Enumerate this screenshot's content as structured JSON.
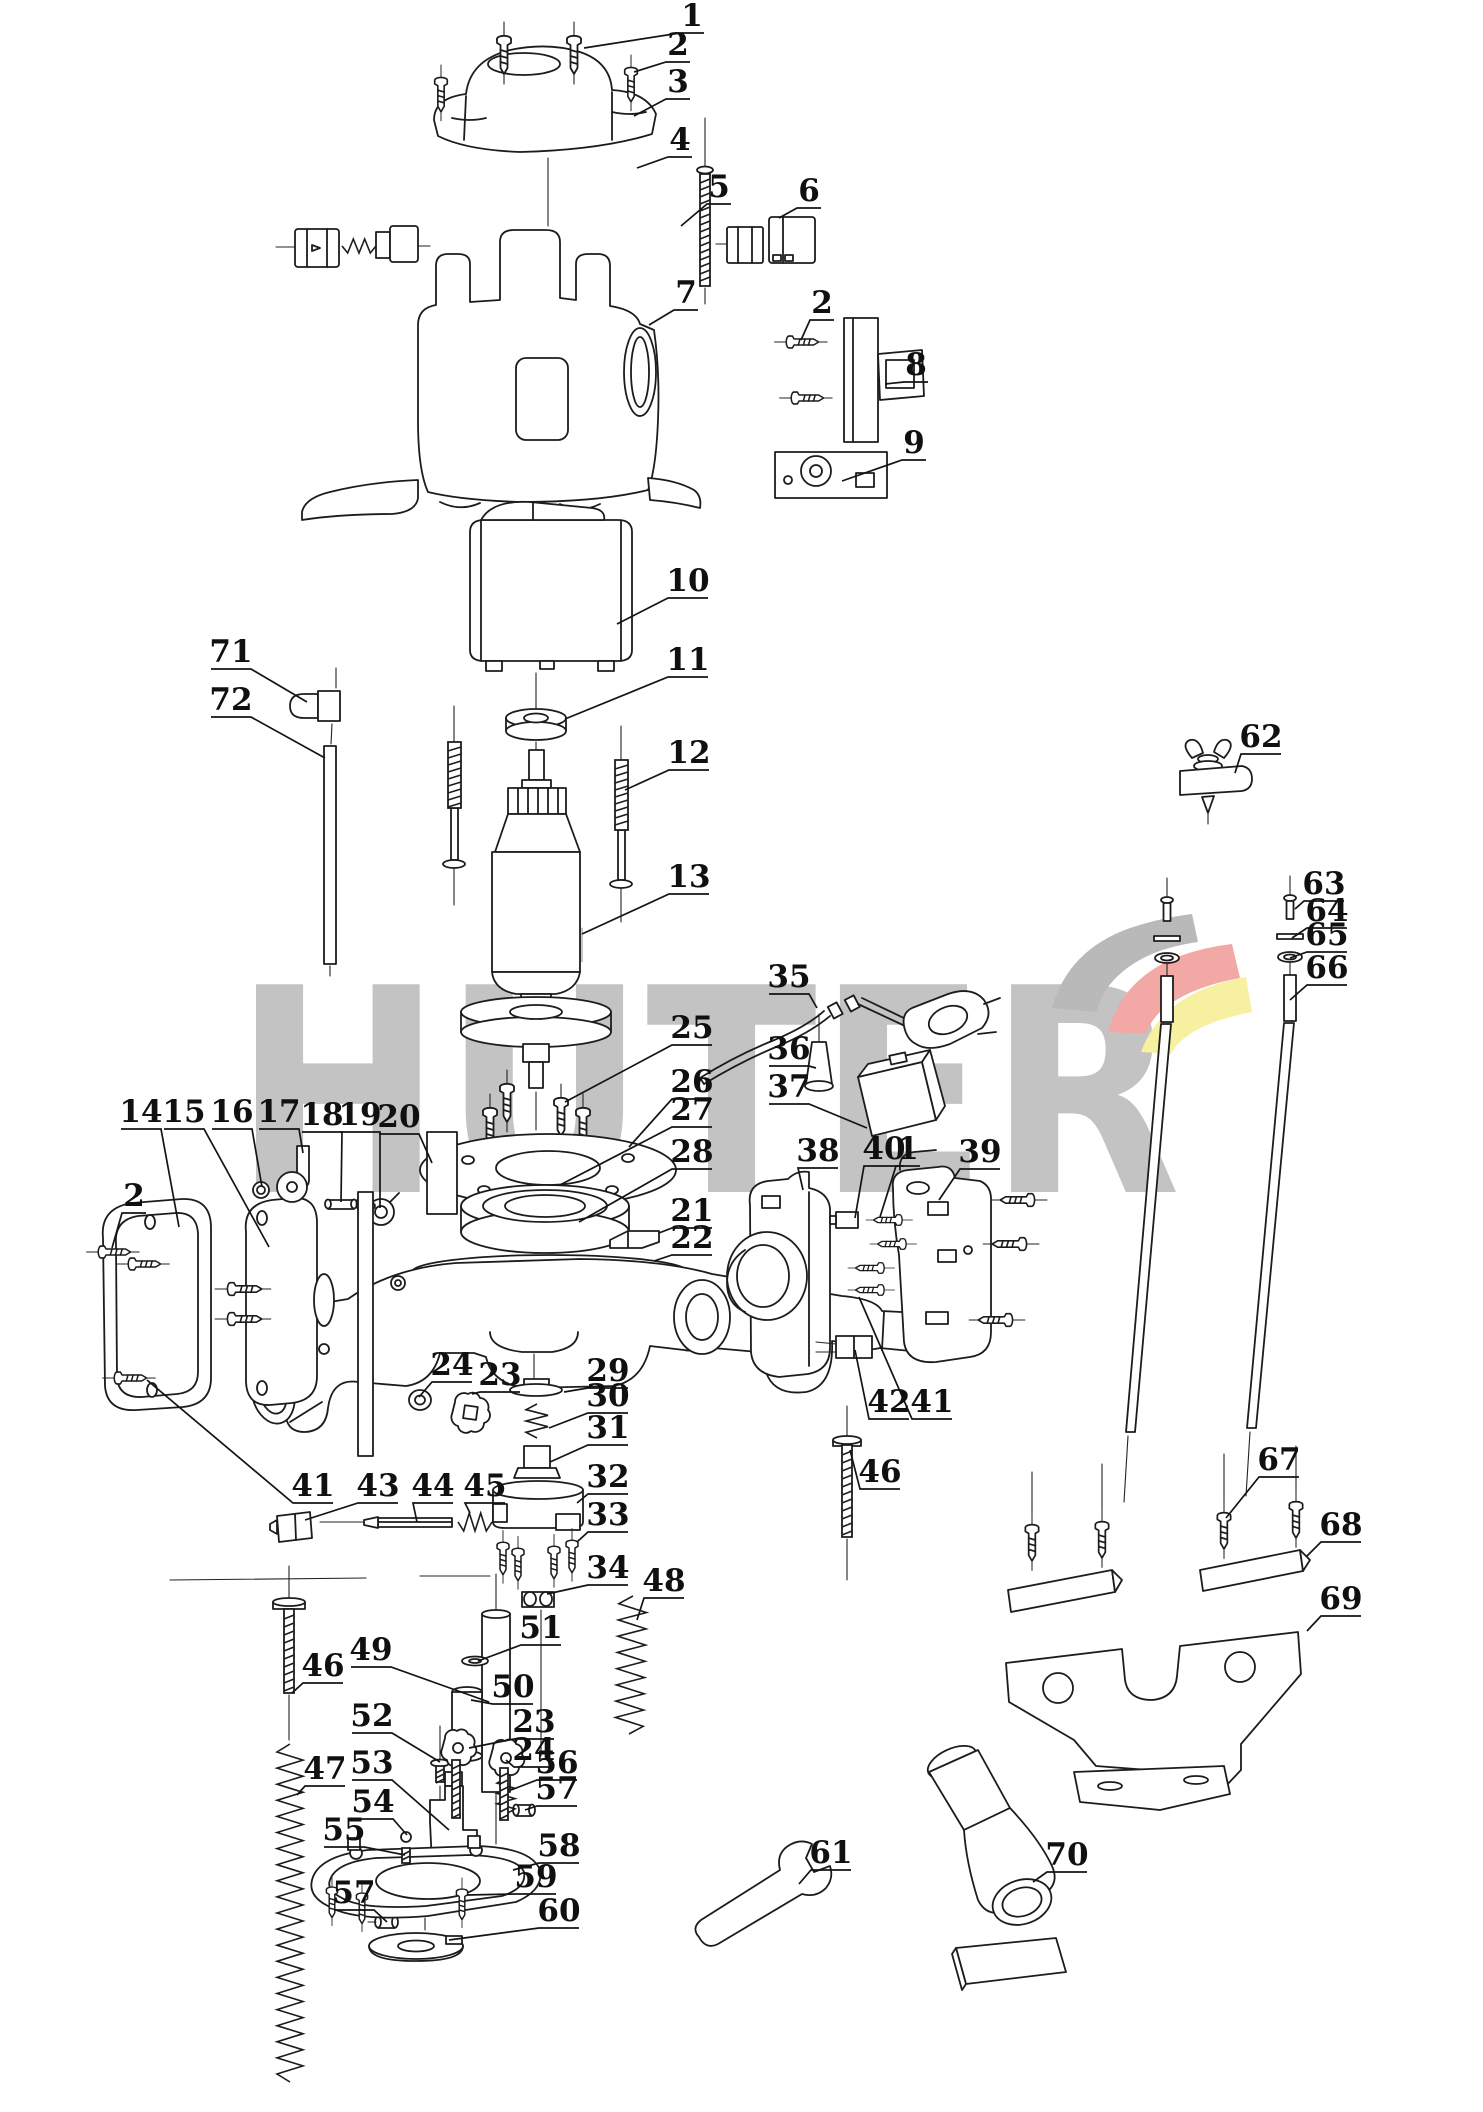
{
  "watermark": {
    "text": "HÜTER",
    "text_color": "#c3c3c3",
    "logo_colors": {
      "gray": "#b9b9b9",
      "red": "#f2a9a6",
      "yellow": "#f7f0a0"
    }
  },
  "canvas": {
    "width": 1483,
    "height": 2112,
    "background": "#ffffff",
    "line_color": "#1c1c1c"
  },
  "callouts": [
    {
      "id": "1",
      "n": "1",
      "x": 692,
      "y": 16,
      "tx": 584,
      "ty": 48
    },
    {
      "id": "2a",
      "n": "2",
      "x": 678,
      "y": 45,
      "tx": 634,
      "ty": 72
    },
    {
      "id": "3",
      "n": "3",
      "x": 678,
      "y": 82,
      "tx": 634,
      "ty": 116
    },
    {
      "id": "4",
      "n": "4",
      "x": 680,
      "y": 140,
      "tx": 637,
      "ty": 168
    },
    {
      "id": "5",
      "n": "5",
      "x": 719,
      "y": 187,
      "tx": 681,
      "ty": 226
    },
    {
      "id": "6",
      "n": "6",
      "x": 809,
      "y": 191,
      "tx": 779,
      "ty": 218
    },
    {
      "id": "7",
      "n": "7",
      "x": 686,
      "y": 293,
      "tx": 649,
      "ty": 325
    },
    {
      "id": "2b",
      "n": "2",
      "x": 822,
      "y": 303,
      "tx": 801,
      "ty": 340
    },
    {
      "id": "8",
      "n": "8",
      "x": 916,
      "y": 365,
      "tx": 885,
      "ty": 384
    },
    {
      "id": "9",
      "n": "9",
      "x": 914,
      "y": 443,
      "tx": 842,
      "ty": 481
    },
    {
      "id": "10",
      "n": "10",
      "x": 688,
      "y": 581,
      "tx": 617,
      "ty": 624
    },
    {
      "id": "11",
      "n": "11",
      "x": 688,
      "y": 660,
      "tx": 565,
      "ty": 719
    },
    {
      "id": "12",
      "n": "12",
      "x": 689,
      "y": 753,
      "tx": 625,
      "ty": 790
    },
    {
      "id": "13",
      "n": "13",
      "x": 689,
      "y": 877,
      "tx": 582,
      "ty": 934
    },
    {
      "id": "71",
      "n": "71",
      "x": 231,
      "y": 652,
      "tx": 307,
      "ty": 702
    },
    {
      "id": "72",
      "n": "72",
      "x": 231,
      "y": 700,
      "tx": 325,
      "ty": 758
    },
    {
      "id": "62",
      "n": "62",
      "x": 1261,
      "y": 737,
      "tx": 1235,
      "ty": 773
    },
    {
      "id": "63",
      "n": "63",
      "x": 1324,
      "y": 884,
      "tx": 1295,
      "ty": 909
    },
    {
      "id": "64",
      "n": "64",
      "x": 1327,
      "y": 911,
      "tx": 1292,
      "ty": 938
    },
    {
      "id": "65",
      "n": "65",
      "x": 1327,
      "y": 935,
      "tx": 1290,
      "ty": 958
    },
    {
      "id": "66",
      "n": "66",
      "x": 1327,
      "y": 968,
      "tx": 1290,
      "ty": 1000
    },
    {
      "id": "25",
      "n": "25",
      "x": 692,
      "y": 1028,
      "tx": 565,
      "ty": 1102
    },
    {
      "id": "26",
      "n": "26",
      "x": 692,
      "y": 1082,
      "tx": 629,
      "ty": 1147
    },
    {
      "id": "27",
      "n": "27",
      "x": 692,
      "y": 1110,
      "tx": 560,
      "ty": 1185
    },
    {
      "id": "28",
      "n": "28",
      "x": 692,
      "y": 1152,
      "tx": 579,
      "ty": 1222
    },
    {
      "id": "21",
      "n": "21",
      "x": 692,
      "y": 1211,
      "tx": 659,
      "ty": 1233
    },
    {
      "id": "22",
      "n": "22",
      "x": 692,
      "y": 1238,
      "tx": 654,
      "ty": 1261
    },
    {
      "id": "35",
      "n": "35",
      "x": 789,
      "y": 977,
      "tx": 817,
      "ty": 1008
    },
    {
      "id": "36",
      "n": "36",
      "x": 789,
      "y": 1049,
      "tx": 816,
      "ty": 1068
    },
    {
      "id": "37",
      "n": "37",
      "x": 789,
      "y": 1087,
      "tx": 867,
      "ty": 1128
    },
    {
      "id": "38",
      "n": "38",
      "x": 818,
      "y": 1151,
      "tx": 803,
      "ty": 1190
    },
    {
      "id": "40",
      "n": "40",
      "x": 884,
      "y": 1149,
      "tx": 855,
      "ty": 1218
    },
    {
      "id": "1b",
      "n": "1",
      "x": 908,
      "y": 1149,
      "tx": 880,
      "ty": 1217
    },
    {
      "id": "39",
      "n": "39",
      "x": 980,
      "y": 1152,
      "tx": 939,
      "ty": 1200
    },
    {
      "id": "41b",
      "n": "41",
      "x": 932,
      "y": 1402,
      "tx": 859,
      "ty": 1297
    },
    {
      "id": "42",
      "n": "42",
      "x": 889,
      "y": 1402,
      "tx": 855,
      "ty": 1350
    },
    {
      "id": "46b",
      "n": "46",
      "x": 880,
      "y": 1472,
      "tx": 850,
      "ty": 1450
    },
    {
      "id": "14",
      "n": "14",
      "x": 141,
      "y": 1112,
      "tx": 179,
      "ty": 1227
    },
    {
      "id": "15",
      "n": "15",
      "x": 184,
      "y": 1112,
      "tx": 269,
      "ty": 1247
    },
    {
      "id": "16",
      "n": "16",
      "x": 232,
      "y": 1112,
      "tx": 262,
      "ty": 1187
    },
    {
      "id": "17",
      "n": "17",
      "x": 279,
      "y": 1112,
      "tx": 303,
      "ty": 1153
    },
    {
      "id": "18",
      "n": "18",
      "x": 322,
      "y": 1115,
      "tx": 341,
      "ty": 1202
    },
    {
      "id": "19",
      "n": "19",
      "x": 360,
      "y": 1115,
      "tx": 380,
      "ty": 1208
    },
    {
      "id": "20",
      "n": "20",
      "x": 399,
      "y": 1117,
      "tx": 432,
      "ty": 1163
    },
    {
      "id": "2c",
      "n": "2",
      "x": 134,
      "y": 1196,
      "tx": 112,
      "ty": 1248
    },
    {
      "id": "24a",
      "n": "24",
      "x": 452,
      "y": 1365,
      "tx": 419,
      "ty": 1397
    },
    {
      "id": "23a",
      "n": "23",
      "x": 500,
      "y": 1375,
      "tx": 472,
      "ty": 1394
    },
    {
      "id": "29",
      "n": "29",
      "x": 608,
      "y": 1371,
      "tx": 564,
      "ty": 1392
    },
    {
      "id": "30",
      "n": "30",
      "x": 608,
      "y": 1396,
      "tx": 549,
      "ty": 1428
    },
    {
      "id": "31",
      "n": "31",
      "x": 608,
      "y": 1428,
      "tx": 550,
      "ty": 1462
    },
    {
      "id": "32",
      "n": "32",
      "x": 608,
      "y": 1477,
      "tx": 577,
      "ty": 1503
    },
    {
      "id": "33",
      "n": "33",
      "x": 608,
      "y": 1515,
      "tx": 577,
      "ty": 1542
    },
    {
      "id": "34",
      "n": "34",
      "x": 608,
      "y": 1568,
      "tx": 547,
      "ty": 1594
    },
    {
      "id": "41a",
      "n": "41",
      "x": 313,
      "y": 1486,
      "tx": 147,
      "ty": 1380
    },
    {
      "id": "43",
      "n": "43",
      "x": 378,
      "y": 1486,
      "tx": 305,
      "ty": 1520
    },
    {
      "id": "44",
      "n": "44",
      "x": 433,
      "y": 1486,
      "tx": 417,
      "ty": 1522
    },
    {
      "id": "45",
      "n": "45",
      "x": 485,
      "y": 1486,
      "tx": 470,
      "ty": 1513
    },
    {
      "id": "46a",
      "n": "46",
      "x": 323,
      "y": 1666,
      "tx": 292,
      "ty": 1693
    },
    {
      "id": "47",
      "n": "47",
      "x": 325,
      "y": 1769,
      "tx": 297,
      "ty": 1795
    },
    {
      "id": "49",
      "n": "49",
      "x": 371,
      "y": 1650,
      "tx": 489,
      "ty": 1702
    },
    {
      "id": "52",
      "n": "52",
      "x": 372,
      "y": 1716,
      "tx": 440,
      "ty": 1762
    },
    {
      "id": "53",
      "n": "53",
      "x": 372,
      "y": 1763,
      "tx": 449,
      "ty": 1830
    },
    {
      "id": "54",
      "n": "54",
      "x": 373,
      "y": 1802,
      "tx": 407,
      "ty": 1835
    },
    {
      "id": "55",
      "n": "55",
      "x": 344,
      "y": 1830,
      "tx": 405,
      "ty": 1855
    },
    {
      "id": "57a",
      "n": "57",
      "x": 354,
      "y": 1893,
      "tx": 387,
      "ty": 1922
    },
    {
      "id": "51",
      "n": "51",
      "x": 541,
      "y": 1628,
      "tx": 478,
      "ty": 1661
    },
    {
      "id": "50",
      "n": "50",
      "x": 513,
      "y": 1687,
      "tx": 471,
      "ty": 1700
    },
    {
      "id": "23b",
      "n": "23",
      "x": 534,
      "y": 1722,
      "tx": 469,
      "ty": 1748
    },
    {
      "id": "24b",
      "n": "24",
      "x": 534,
      "y": 1750,
      "tx": 506,
      "ty": 1760
    },
    {
      "id": "56",
      "n": "56",
      "x": 557,
      "y": 1763,
      "tx": 511,
      "ty": 1790
    },
    {
      "id": "57b",
      "n": "57",
      "x": 557,
      "y": 1789,
      "tx": 525,
      "ty": 1810
    },
    {
      "id": "58",
      "n": "58",
      "x": 559,
      "y": 1846,
      "tx": 513,
      "ty": 1870
    },
    {
      "id": "59",
      "n": "59",
      "x": 536,
      "y": 1877,
      "tx": 467,
      "ty": 1895
    },
    {
      "id": "60",
      "n": "60",
      "x": 559,
      "y": 1911,
      "tx": 449,
      "ty": 1940
    },
    {
      "id": "48",
      "n": "48",
      "x": 664,
      "y": 1581,
      "tx": 637,
      "ty": 1620
    },
    {
      "id": "61",
      "n": "61",
      "x": 831,
      "y": 1853,
      "tx": 799,
      "ty": 1884
    },
    {
      "id": "70",
      "n": "70",
      "x": 1067,
      "y": 1855,
      "tx": 1033,
      "ty": 1882
    },
    {
      "id": "67",
      "n": "67",
      "x": 1279,
      "y": 1460,
      "tx": 1226,
      "ty": 1518
    },
    {
      "id": "68",
      "n": "68",
      "x": 1341,
      "y": 1525,
      "tx": 1307,
      "ty": 1556
    },
    {
      "id": "69",
      "n": "69",
      "x": 1341,
      "y": 1599,
      "tx": 1307,
      "ty": 1631
    }
  ]
}
